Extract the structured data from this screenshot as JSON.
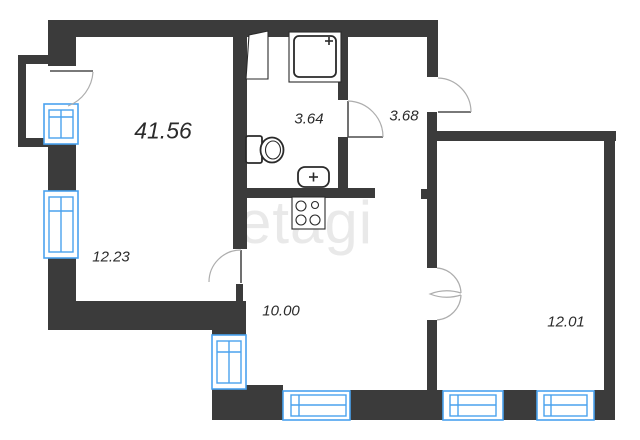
{
  "title": "apartment floor plan",
  "watermark": "etagi",
  "total_area": "41.56",
  "rooms": [
    {
      "name": "living-room",
      "area": "12.23"
    },
    {
      "name": "bathroom",
      "area": "3.64"
    },
    {
      "name": "hallway",
      "area": "3.68"
    },
    {
      "name": "kitchen",
      "area": "10.00"
    },
    {
      "name": "bedroom",
      "area": "12.01"
    }
  ],
  "fixtures": [
    "shower",
    "wardrobe",
    "toilet",
    "washbasin",
    "stove"
  ],
  "colors": {
    "wall": "#3b3b3b",
    "window": "#4aa2ee",
    "background": "#ffffff",
    "label": "#2b2b2b",
    "watermark": "#e9e9e9",
    "door_arc": "#adadad"
  }
}
